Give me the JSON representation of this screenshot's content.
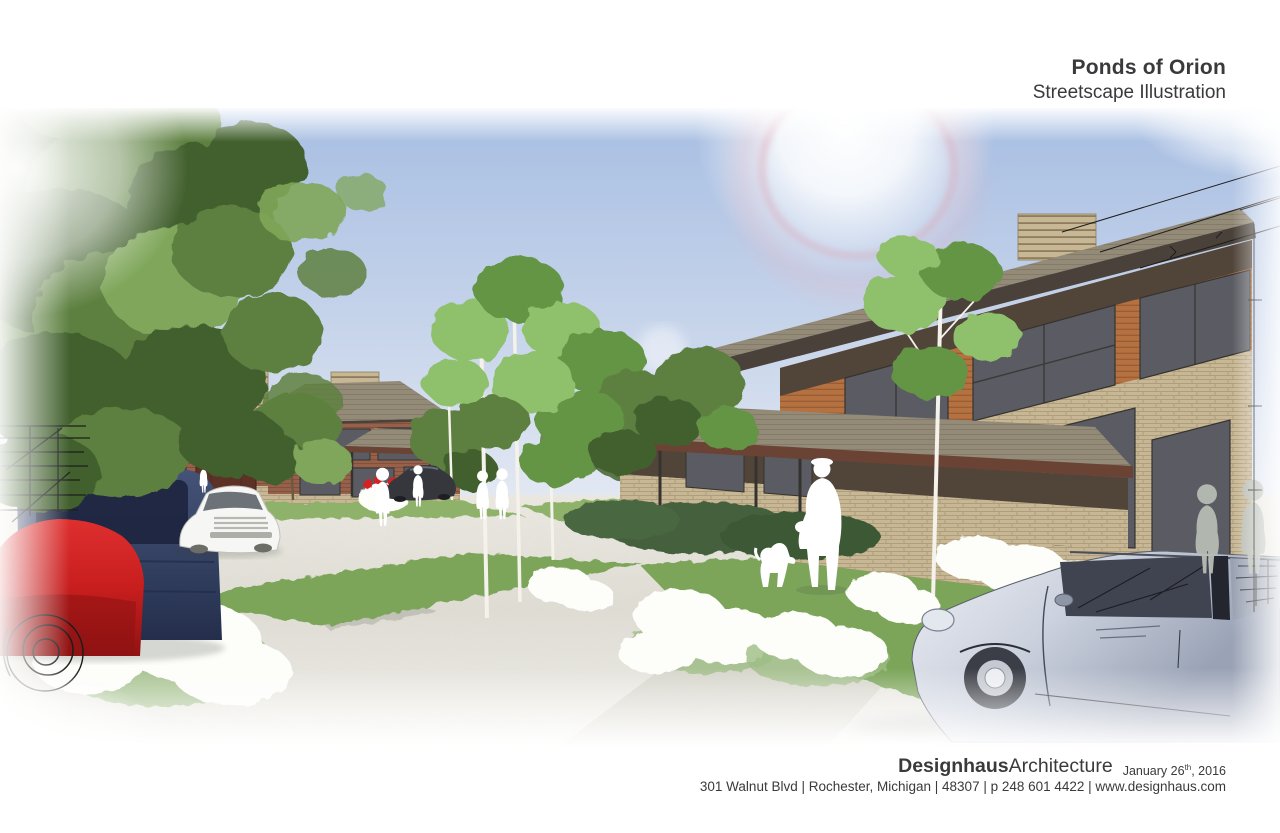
{
  "sheet": {
    "title": "Ponds of Orion",
    "subtitle": "Streetscape Illustration"
  },
  "footer": {
    "firm_name_bold": "Designhaus",
    "firm_name_light": "Architecture",
    "date_main": "January 26",
    "date_superscript": "th",
    "date_tail": ", 2016",
    "address_line": "301 Walnut Blvd | Rochester, Michigan | 48307 | p 248 601 4422 | www.designhaus.com"
  },
  "illustration": {
    "description": "Watercolor-style architectural streetscape rendering: two prairie-modern buildings with wood siding, tan brick and broad hip roofs, birch trees, white figures walking a dog, parked cars, a red and navy car at left, a silver sedan in the foreground fading into hand sketch lines at the edges, under a blue sky with a sun lens flare.",
    "palette": {
      "textColor": "#3a3a3c",
      "skyTop": "#a7bee2",
      "skyMid": "#ccd8ec",
      "skyHorizon": "#eef1f6",
      "pavement": "#e0ded5",
      "pavementFar": "#eceae2",
      "lawn": "#7ba55a",
      "lawnLight": "#8fb26a",
      "hedge": "#44603c",
      "canopyDark": "#42612f",
      "canopyMid": "#5d8040",
      "canopyLight": "#7fa65a",
      "birchLeaf": "#8fc06c",
      "birchLeafDark": "#639544",
      "spruce": "#4d6c53",
      "roofGray": "#938a77",
      "roofFascia": "#4a423a",
      "wingFascia": "#6b4334",
      "woodSiding": "#b5713f",
      "woodDark": "#8a5430",
      "clerestory": "#51453a",
      "brickTan": "#c8b795",
      "brickJoint": "#a3926f",
      "brickRed": "#96604a",
      "garageDoor": "#5c3226",
      "windowGlass": "#5b5c63",
      "windowFrame": "#35332f",
      "redCar": "#c81e1e",
      "navyCar": "#35426388",
      "navyCarSolid": "#354263",
      "whiteCar": "#f6f6f4",
      "darkCar": "#35373d",
      "silverLight": "#ccd2de",
      "silverShade": "#9aa3b6",
      "glassCar": "#3f4450",
      "figureWhite": "#ffffff",
      "figureGray": "#b7bcb4",
      "flowerRed": "#d42222",
      "sketchInk": "#1c1c1c"
    }
  }
}
